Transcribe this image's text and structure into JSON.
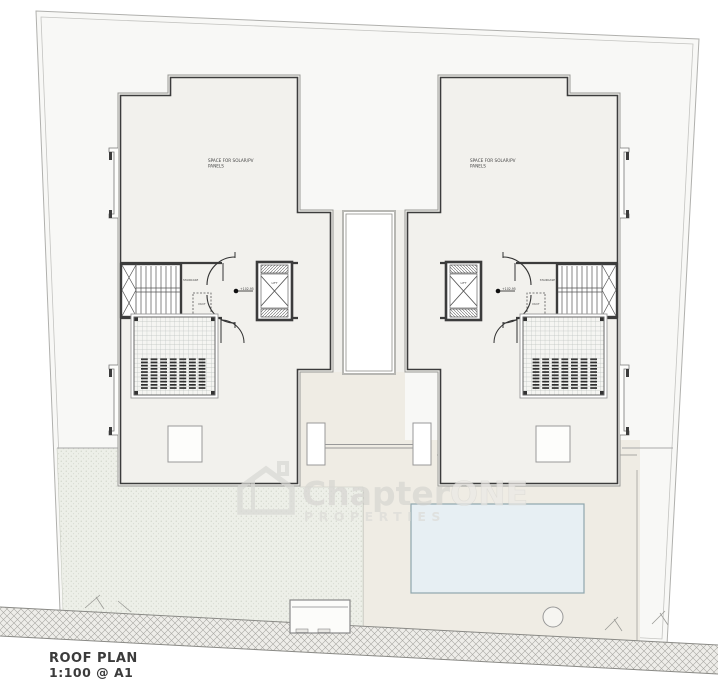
{
  "title_block": {
    "title": "ROOF PLAN",
    "scale": "1:100 @ A1"
  },
  "watermark": {
    "brand_primary": "Chapter",
    "brand_accent": "ONE",
    "tagline": "PROPERTIES",
    "logo": "house-icon"
  },
  "annotations": {
    "solar_line1": "SPACE FOR SOLAR/PV",
    "solar_line2": "PANELS",
    "lift": "LIFT",
    "staircase": "STAIRCASE",
    "duct": "DUCT",
    "level": "+102.95"
  },
  "colors": {
    "wall": "#3c3c3c",
    "roof_fill": "#f2f1ed",
    "site_fill": "#f8f8f6",
    "garden_fill": "#edefe8",
    "terrace_fill": "#efece4",
    "pool_fill": "#e7eff3",
    "watermark_primary": "#d7d6d2",
    "watermark_accent": "#eceae6"
  }
}
